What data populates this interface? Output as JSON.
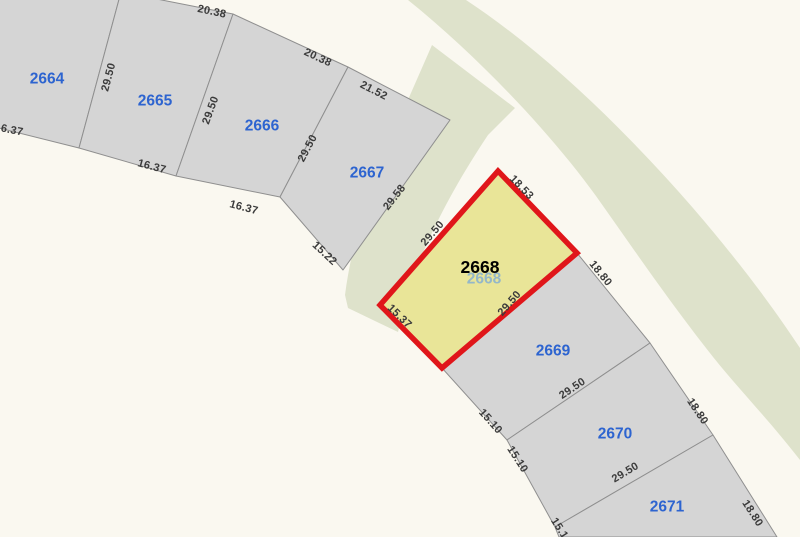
{
  "map": {
    "type": "cadastral-parcel-map",
    "colors": {
      "background": "#faf8f0",
      "parcel_fill": "#d5d5d5",
      "parcel_stroke": "#8f8f8f",
      "green_area": "#dee2cb",
      "selected_fill": "#e9e598",
      "selected_stroke": "#e0161a",
      "parcel_label": "#2d64d0",
      "dimension_label": "#3b3b3b",
      "selected_label": "#000000",
      "ghost_label": "#86afd2"
    },
    "green_areas": [
      {
        "name": "green-belt",
        "path": "M 408,0 L 466,0 C 545,52 625,130 693,208 C 748,272 778,315 800,348 L 800,460 C 765,415 737,388 706,348 C 664,294 630,244 596,196 C 552,135 480,58 408,0 Z"
      },
      {
        "name": "green-strip",
        "path": "M 432,45 L 515,108 L 488,135 C 458,180 430,230 408,290 L 398,332 L 348,308 L 345,295 C 352,240 372,175 400,118 Z"
      }
    ],
    "parcels": [
      {
        "id": "2664",
        "points": [
          [
            -25,
            -15
          ],
          [
            121,
            -8
          ],
          [
            79,
            148
          ],
          [
            -25,
            122
          ]
        ],
        "label": {
          "x": 47,
          "y": 78
        }
      },
      {
        "id": "2665",
        "points": [
          [
            121,
            -8
          ],
          [
            233,
            14
          ],
          [
            176,
            176
          ],
          [
            79,
            148
          ]
        ],
        "label": {
          "x": 155,
          "y": 100
        }
      },
      {
        "id": "2666",
        "points": [
          [
            233,
            14
          ],
          [
            348,
            67
          ],
          [
            280,
            197
          ],
          [
            176,
            176
          ]
        ],
        "label": {
          "x": 262,
          "y": 125
        }
      },
      {
        "id": "2667",
        "points": [
          [
            348,
            67
          ],
          [
            450,
            120
          ],
          [
            343,
            270
          ],
          [
            280,
            197
          ]
        ],
        "label": {
          "x": 367,
          "y": 172
        }
      },
      {
        "id": "2669",
        "points": [
          [
            577,
            253
          ],
          [
            650,
            343
          ],
          [
            507,
            440
          ],
          [
            442,
            368
          ]
        ],
        "label": {
          "x": 553,
          "y": 350
        }
      },
      {
        "id": "2670",
        "points": [
          [
            650,
            343
          ],
          [
            713,
            435
          ],
          [
            555,
            527
          ],
          [
            507,
            440
          ]
        ],
        "label": {
          "x": 615,
          "y": 433
        }
      },
      {
        "id": "2671",
        "points": [
          [
            713,
            435
          ],
          [
            777,
            537
          ],
          [
            559,
            537
          ],
          [
            555,
            527
          ]
        ],
        "label": {
          "x": 667,
          "y": 506
        }
      }
    ],
    "selected_parcel": {
      "id": "2668",
      "points": [
        [
          498,
          171
        ],
        [
          577,
          253
        ],
        [
          442,
          368
        ],
        [
          380,
          305
        ]
      ],
      "label": {
        "x": 480,
        "y": 267
      },
      "ghost_label": {
        "x": 484,
        "y": 278
      }
    },
    "dimensions": [
      {
        "text": "20.38",
        "x": 212,
        "y": 11,
        "rot": 12
      },
      {
        "text": "20.38",
        "x": 318,
        "y": 57,
        "rot": 25
      },
      {
        "text": "21.52",
        "x": 374,
        "y": 90,
        "rot": 27
      },
      {
        "text": "29.50",
        "x": 108,
        "y": 77,
        "rot": -75
      },
      {
        "text": "29.50",
        "x": 210,
        "y": 110,
        "rot": -70
      },
      {
        "text": "29.50",
        "x": 307,
        "y": 148,
        "rot": -62
      },
      {
        "text": "29.58",
        "x": 394,
        "y": 197,
        "rot": -52
      },
      {
        "text": "16.37",
        "x": 9,
        "y": 129,
        "rot": 11
      },
      {
        "text": "16.37",
        "x": 152,
        "y": 166,
        "rot": 15
      },
      {
        "text": "16.37",
        "x": 244,
        "y": 207,
        "rot": 15
      },
      {
        "text": "15.22",
        "x": 325,
        "y": 253,
        "rot": 43
      },
      {
        "text": "29.50",
        "x": 432,
        "y": 233,
        "rot": -49
      },
      {
        "text": "18.53",
        "x": 522,
        "y": 187,
        "rot": 46
      },
      {
        "text": "15.37",
        "x": 400,
        "y": 316,
        "rot": 44
      },
      {
        "text": "29.50",
        "x": 509,
        "y": 303,
        "rot": -49
      },
      {
        "text": "18.80",
        "x": 601,
        "y": 273,
        "rot": 51
      },
      {
        "text": "29.50",
        "x": 572,
        "y": 388,
        "rot": -34
      },
      {
        "text": "15.10",
        "x": 491,
        "y": 421,
        "rot": 48
      },
      {
        "text": "15.10",
        "x": 518,
        "y": 459,
        "rot": 57
      },
      {
        "text": "18.80",
        "x": 698,
        "y": 411,
        "rot": 56
      },
      {
        "text": "29.50",
        "x": 625,
        "y": 472,
        "rot": -31
      },
      {
        "text": "18.80",
        "x": 753,
        "y": 513,
        "rot": 57
      },
      {
        "text": "15.1",
        "x": 560,
        "y": 528,
        "rot": 57
      }
    ]
  }
}
